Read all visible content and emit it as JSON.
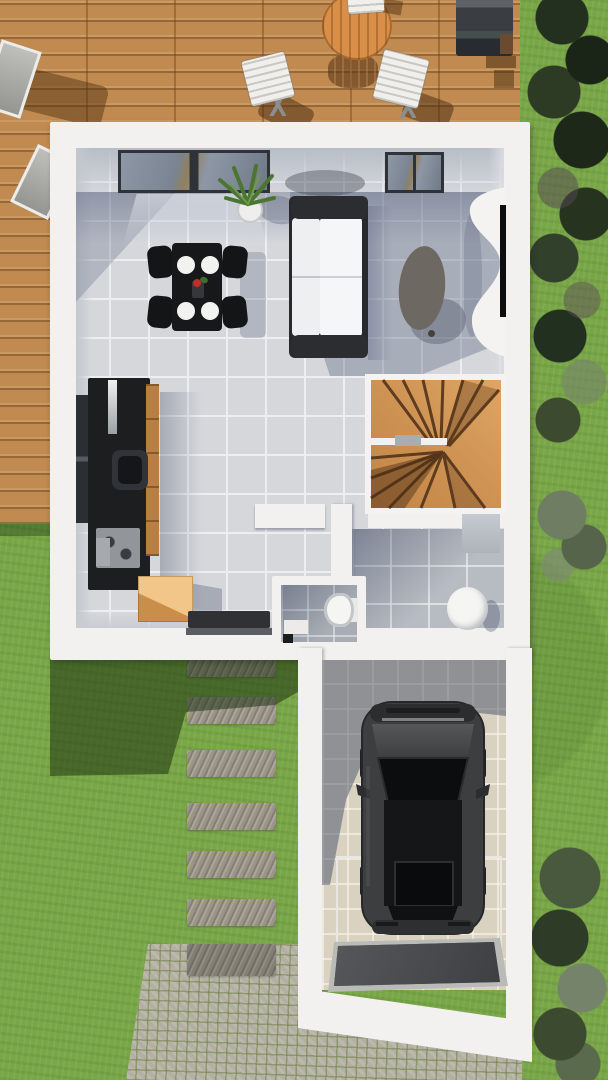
{
  "scene": {
    "type": "architectural-3d-floorplan-render",
    "view": "top-down ground floor with garden, terrace and garage",
    "description": "Top-down 3D render: wooden terrace with table, chairs, loungers and barbecue at top; white-walled ground floor with living room, kitchen, winder staircase, WC and entry hall; lawn with stepping-stone path and cobblestone driveway leading to a garage containing a dark car; dense hedges along the right edge."
  },
  "colors": {
    "grass": "#79a747",
    "deck_wood": "#c08a50",
    "wall_white": "#f2f1ef",
    "floor_tile": "#d5d7db",
    "hall_tile": "#b7bbc2",
    "wc_tile": "#a8adb5",
    "garage_tile": "#d9d2c0",
    "stair_wood": "#cf9254",
    "stair_tread": "#5f3c1f",
    "kitchen_unit": "#1c1e20",
    "kitchen_wood": "#b97e42",
    "moving_box": "#e4a65c",
    "sofa_frame": "#28292c",
    "sofa_cushion": "#edeff1",
    "dining_table": "#17181a",
    "plate_white": "#f2f2f0",
    "coffee_table": "#6d6861",
    "tv_black": "#0c0d0e",
    "console_white": "#f4f3f1",
    "sanitary_white": "#f5f5f3",
    "cabinet_gray": "#aeb3ba",
    "door_mat": "#2f3134",
    "car_body": "#3d3e40",
    "car_glass": "#0c0d0e",
    "garage_mat": "#47494c",
    "paving_stone": "#9b9588",
    "cobblestone": "#b3b0a3",
    "terrace_table": "#d98f47",
    "terrace_chair": "#f0efec",
    "barbecue": "#3a3e43",
    "lounger": "#a9a9a5",
    "hedge_dark": "#273522",
    "plant_green": "#4c7534",
    "window_frame": "#2f3337"
  },
  "objects": {
    "terrace": "wooden terrace deck",
    "terrace_table": "round wooden terrace table",
    "terrace_chairs": "white folding chairs",
    "loungers": "sun loungers",
    "barbecue": "barbecue grill",
    "house": "ground floor of house",
    "living_room": "living room",
    "sofa": "two-seat sofa",
    "dining_set": "dining table with four chairs and place settings",
    "coffee_table": "oval coffee table",
    "tv_console": "curved TV console with wall TV",
    "plant": "potted agave plant",
    "kitchen": "kitchen block with sink and cooktop",
    "moving_box": "cardboard box",
    "staircase": "quarter-turn winder staircase",
    "wc": "WC with toilet",
    "entry_hall": "entry hall with round basin and cabinet",
    "door_mat": "entry door mat",
    "garage": "garage",
    "car": "dark SUV parked in garage",
    "garage_mat": "garage entrance ramp mat",
    "stepping_stones": "stepping stone path",
    "driveway": "cobblestone driveway",
    "hedge": "hedge along right boundary",
    "lawn": "lawn"
  }
}
